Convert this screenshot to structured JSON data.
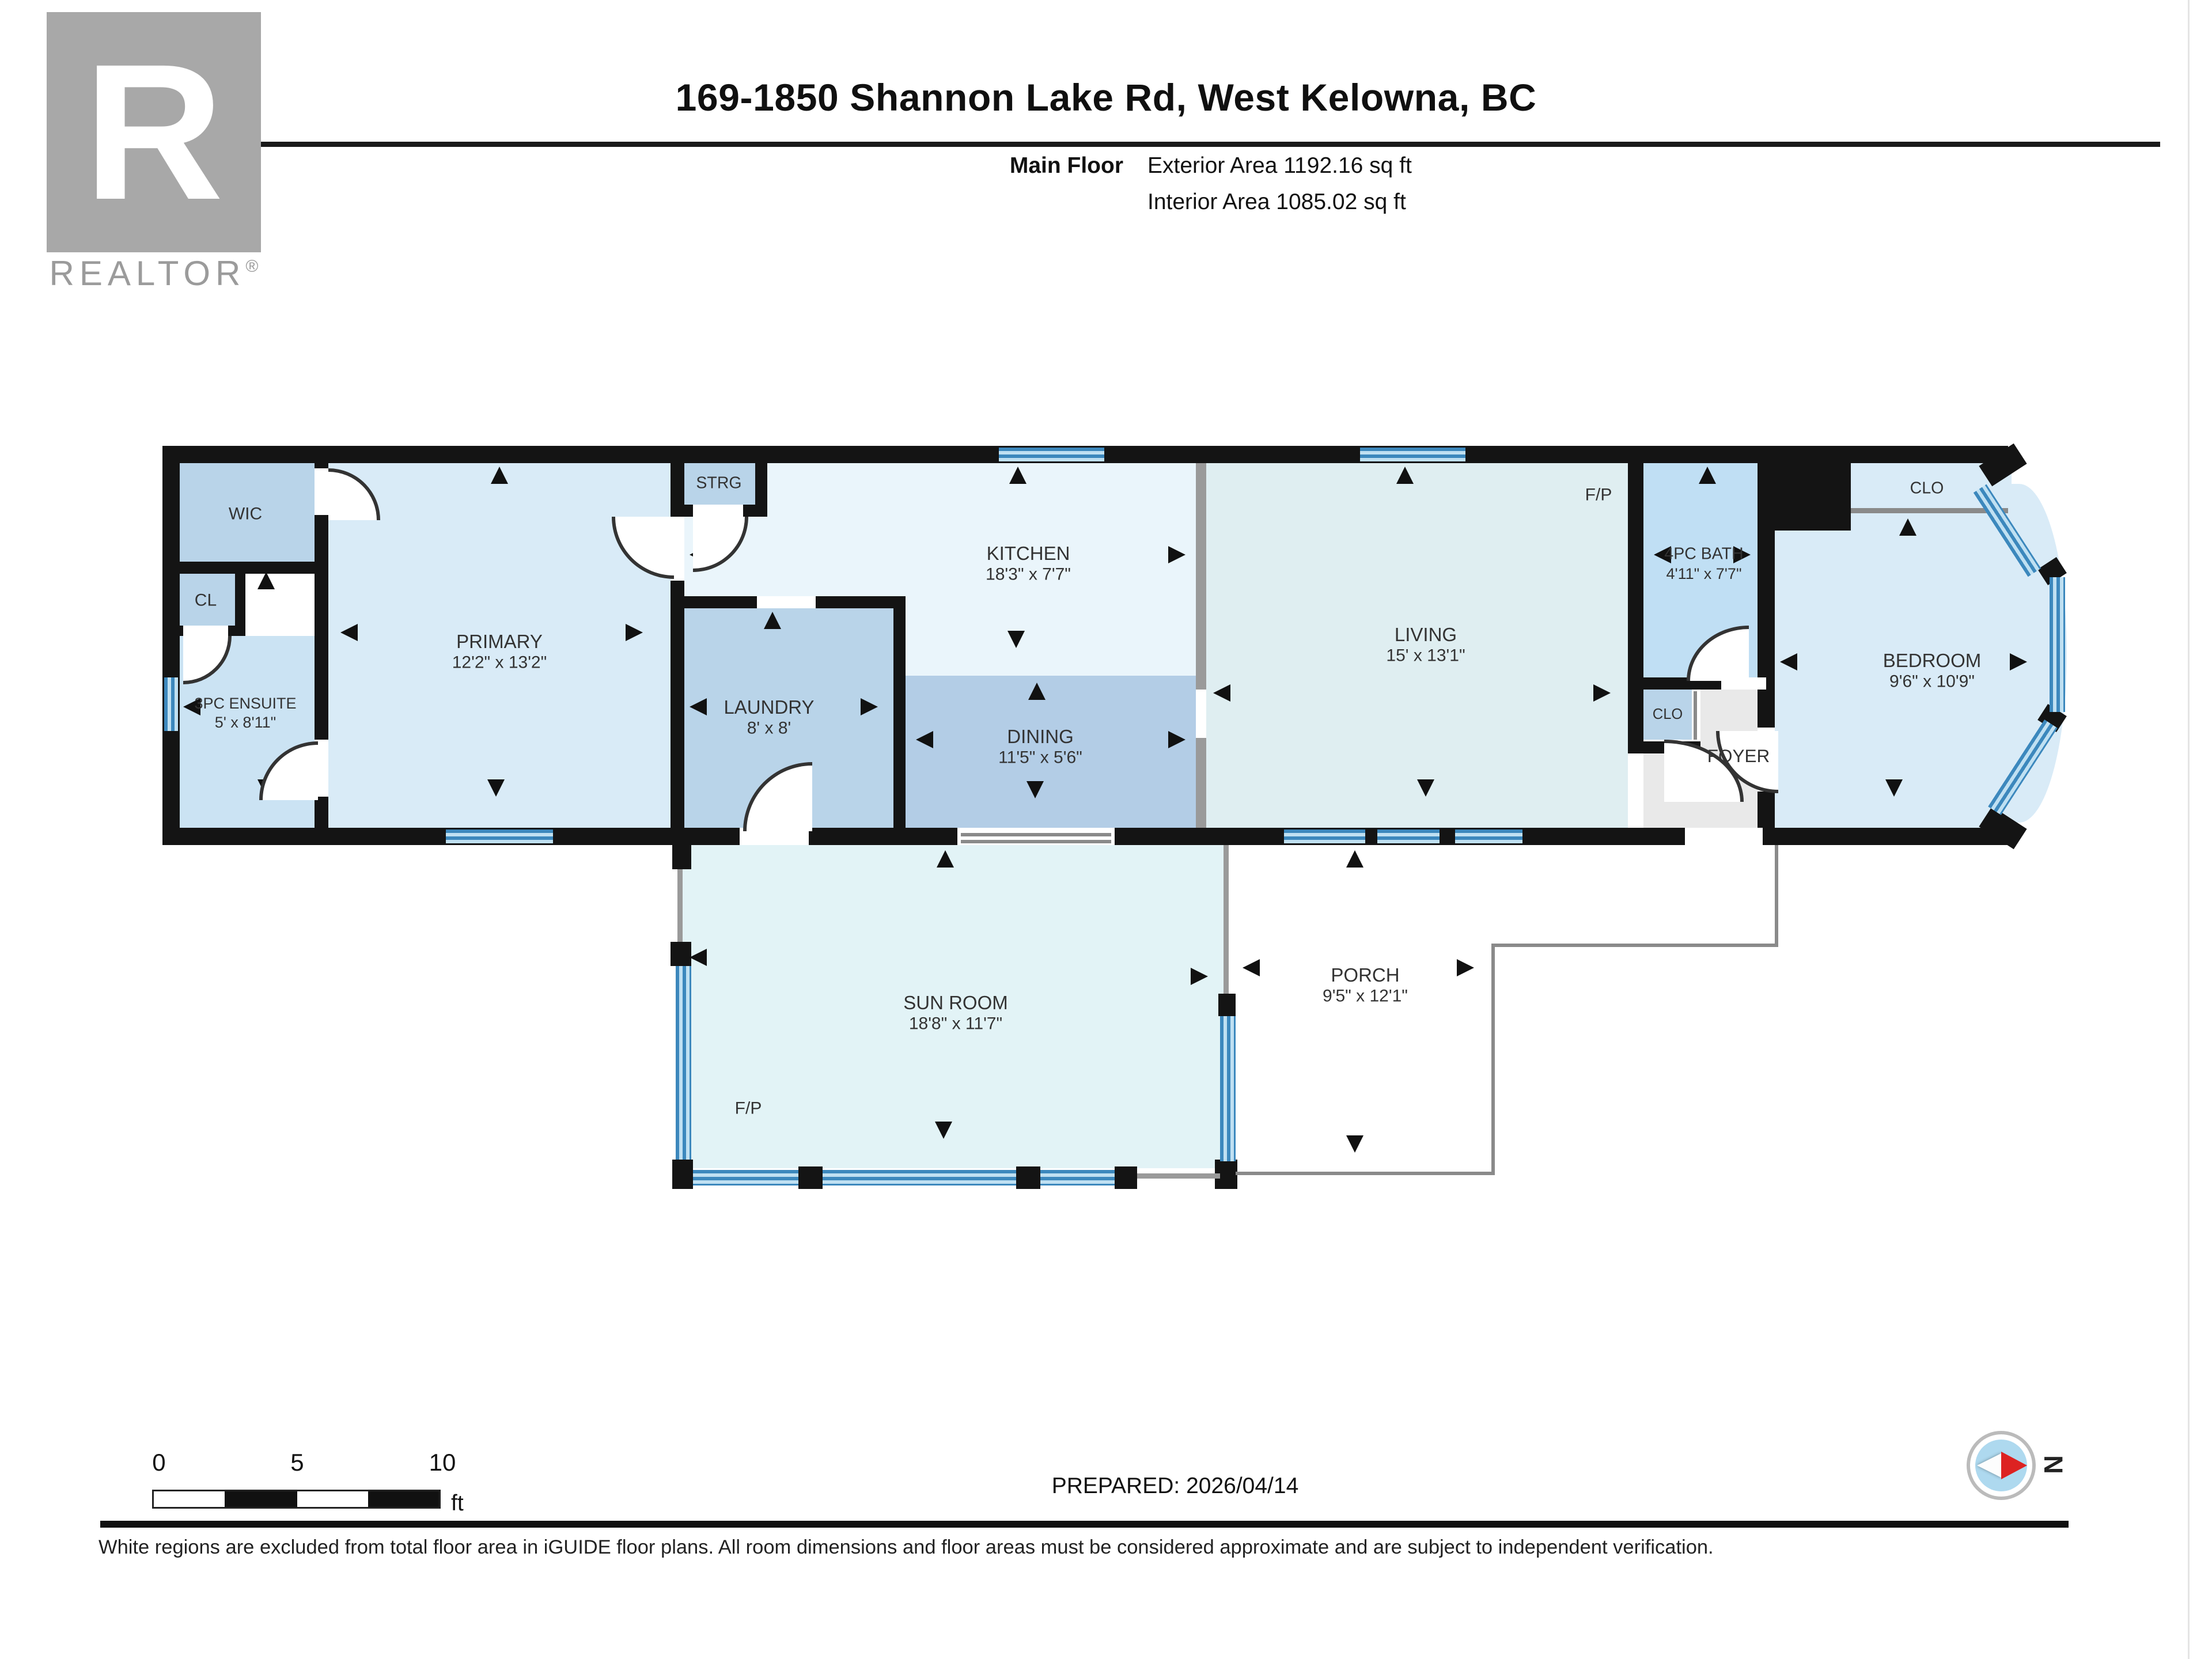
{
  "header": {
    "title": "169-1850 Shannon Lake Rd, West Kelowna, BC",
    "floor_label": "Main Floor",
    "exterior_area": "Exterior Area 1192.16 sq ft",
    "interior_area": "Interior Area 1085.02 sq ft"
  },
  "logo": {
    "letter": "R",
    "brand": "REALTOR",
    "registered": "®"
  },
  "fireplace_label": "F/P",
  "rooms": [
    {
      "id": "wic",
      "name": "WIC",
      "dims": ""
    },
    {
      "id": "cl",
      "name": "CL",
      "dims": ""
    },
    {
      "id": "ensuite",
      "name": "3PC ENSUITE",
      "dims": "5' x 8'11\""
    },
    {
      "id": "primary",
      "name": "PRIMARY",
      "dims": "12'2\" x 13'2\""
    },
    {
      "id": "strg",
      "name": "STRG",
      "dims": ""
    },
    {
      "id": "kitchen",
      "name": "KITCHEN",
      "dims": "18'3\" x 7'7\""
    },
    {
      "id": "laundry",
      "name": "LAUNDRY",
      "dims": "8' x 8'"
    },
    {
      "id": "dining",
      "name": "DINING",
      "dims": "11'5\" x 5'6\""
    },
    {
      "id": "living",
      "name": "LIVING",
      "dims": "15' x 13'1\""
    },
    {
      "id": "bath",
      "name": "4PC BATH",
      "dims": "4'11\" x 7'7\""
    },
    {
      "id": "clo-hall",
      "name": "CLO",
      "dims": ""
    },
    {
      "id": "foyer",
      "name": "FOYER",
      "dims": ""
    },
    {
      "id": "clo-bedroom",
      "name": "CLO",
      "dims": ""
    },
    {
      "id": "bedroom",
      "name": "BEDROOM",
      "dims": "9'6\" x 10'9\""
    },
    {
      "id": "sunroom",
      "name": "SUN ROOM",
      "dims": "18'8\" x 11'7\""
    },
    {
      "id": "porch",
      "name": "PORCH",
      "dims": "9'5\" x 12'1\""
    }
  ],
  "scale_bar": {
    "start": "0",
    "mid": "5",
    "end": "10",
    "unit": "ft"
  },
  "footer": {
    "prepared": "PREPARED: 2026/04/14",
    "disclaimer": "White regions are excluded from total floor area in iGUIDE floor plans. All room dimensions and floor areas must be considered approximate and are subject to independent verification.",
    "compass_north": "N"
  },
  "colors": {
    "wall": "#141414",
    "window_blue": "#3c88bd",
    "room_light": "#d9ebf7",
    "room_medium": "#b9d4e9",
    "room_pale": "#eaf5fb",
    "bath_blue": "#c0dff4",
    "foyer_gray": "#e9e9e9",
    "compass_red": "#dd2222"
  }
}
